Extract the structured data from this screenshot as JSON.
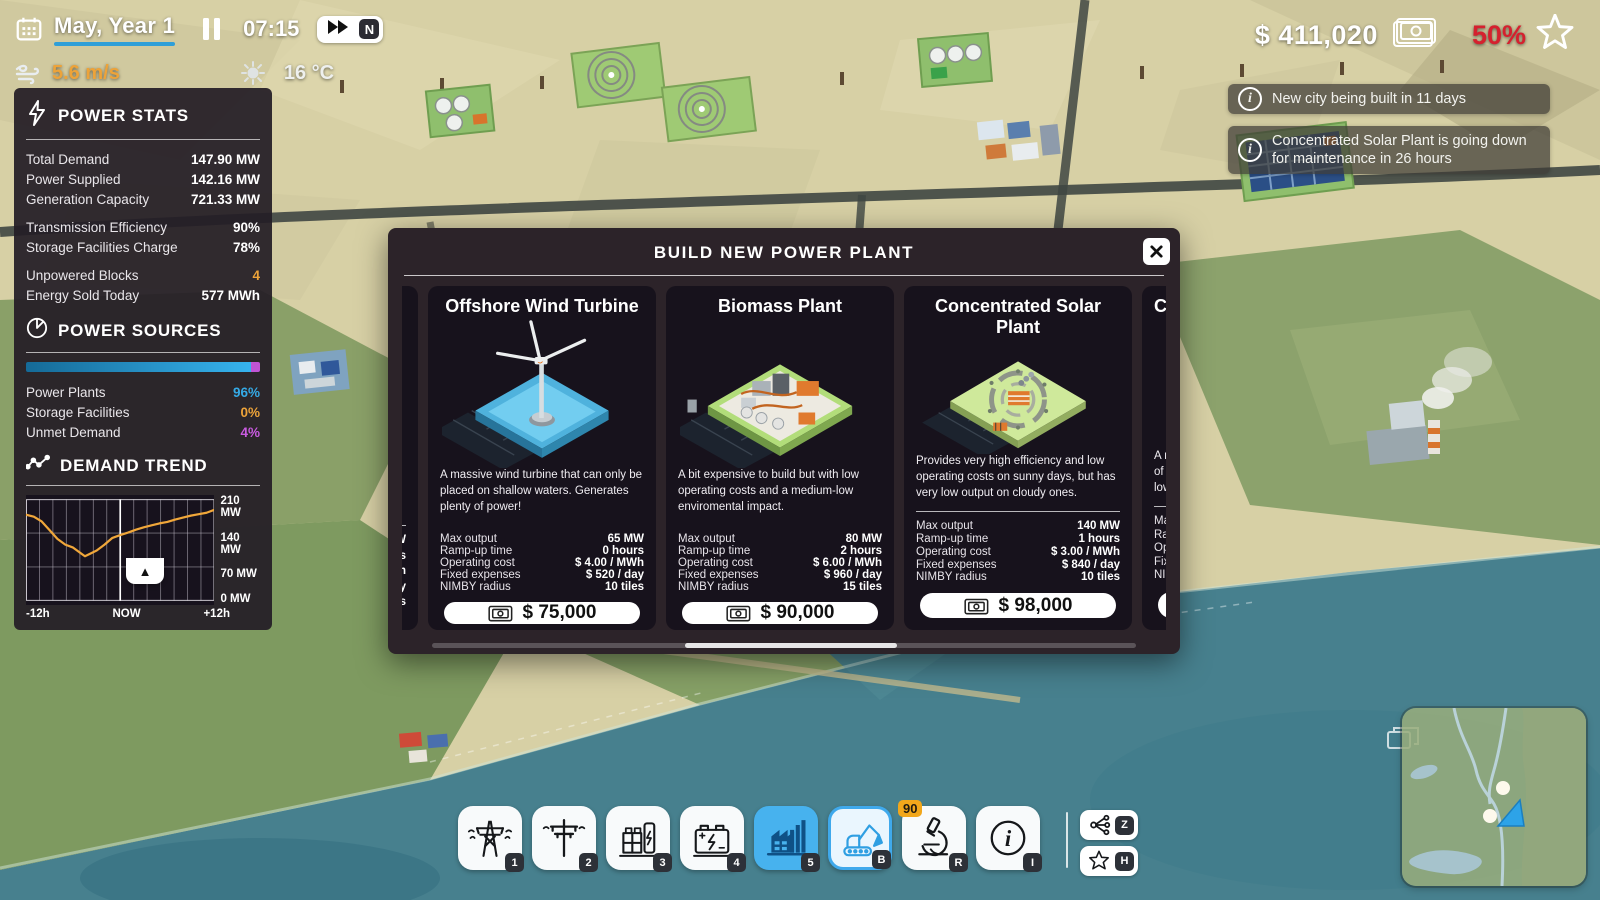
{
  "hud": {
    "date": "May, Year 1",
    "time": "07:15",
    "speed_mode": "N",
    "wind_speed": "5.6 m/s",
    "temperature": "16 °C",
    "money": "$ 411,020",
    "approval": "50%"
  },
  "notifications": [
    {
      "text": "New city being built in 11 days"
    },
    {
      "text": "Concentrated Solar Plant is going down for maintenance in 26 hours"
    }
  ],
  "power_stats": {
    "title": "POWER STATS",
    "rows": [
      {
        "label": "Total Demand",
        "value": "147.90 MW"
      },
      {
        "label": "Power Supplied",
        "value": "142.16 MW"
      },
      {
        "label": "Generation Capacity",
        "value": "721.33 MW"
      },
      {
        "label": "Transmission Efficiency",
        "value": "90%"
      },
      {
        "label": "Storage Facilities Charge",
        "value": "78%"
      },
      {
        "label": "Unpowered Blocks",
        "value": "4"
      },
      {
        "label": "Energy Sold Today",
        "value": "577 MWh"
      }
    ]
  },
  "power_sources": {
    "title": "POWER SOURCES",
    "bar": {
      "plants_pct": 96,
      "unmet_pct": 4
    },
    "rows": [
      {
        "label": "Power Plants",
        "value": "96%"
      },
      {
        "label": "Storage Facilities",
        "value": "0%"
      },
      {
        "label": "Unmet Demand",
        "value": "4%"
      }
    ]
  },
  "chart_data": {
    "type": "line",
    "title": "DEMAND TREND",
    "xlabel": "time relative to now (hours)",
    "ylabel": "MW",
    "ylim": [
      0,
      210
    ],
    "x_range": [
      -12,
      12
    ],
    "grid": true,
    "yticks": [
      "210 MW",
      "140 MW",
      "70 MW",
      "0 MW"
    ],
    "xticks": [
      "-12h",
      "NOW",
      "+12h"
    ],
    "series": [
      {
        "name": "Demand",
        "color": "#f0a73a",
        "points": [
          [
            -12,
            178
          ],
          [
            -11,
            174
          ],
          [
            -10,
            164
          ],
          [
            -9,
            146
          ],
          [
            -8,
            128
          ],
          [
            -7,
            116
          ],
          [
            -6,
            110
          ],
          [
            -5,
            98
          ],
          [
            -4.5,
            92
          ],
          [
            -4,
            96
          ],
          [
            -3,
            104
          ],
          [
            -2,
            116
          ],
          [
            -1,
            130
          ],
          [
            0,
            136
          ],
          [
            1,
            141
          ],
          [
            2,
            147
          ],
          [
            3,
            152
          ],
          [
            4,
            156
          ],
          [
            5,
            160
          ],
          [
            6,
            163
          ],
          [
            7,
            168
          ],
          [
            8,
            172
          ],
          [
            9,
            176
          ],
          [
            10,
            179
          ],
          [
            11,
            182
          ],
          [
            12,
            188
          ]
        ]
      }
    ]
  },
  "modal": {
    "title": "BUILD NEW POWER PLANT",
    "close_glyph": "✕",
    "cards": [
      {
        "title": "Offshore Wind Turbine",
        "description": "A massive wind turbine that can only be placed on shallow waters. Generates plenty of power!",
        "stats": [
          [
            "Max output",
            "65 MW"
          ],
          [
            "Ramp-up time",
            "0 hours"
          ],
          [
            "Operating cost",
            "$ 4.00 / MWh"
          ],
          [
            "Fixed expenses",
            "$ 520 / day"
          ],
          [
            "NIMBY radius",
            "10 tiles"
          ]
        ],
        "price": "$ 75,000"
      },
      {
        "title": "Biomass Plant",
        "description": "A bit expensive to build but with low operating costs and a medium-low enviromental impact.",
        "stats": [
          [
            "Max output",
            "80 MW"
          ],
          [
            "Ramp-up time",
            "2 hours"
          ],
          [
            "Operating cost",
            "$ 6.00 / MWh"
          ],
          [
            "Fixed expenses",
            "$ 960 / day"
          ],
          [
            "NIMBY radius",
            "15 tiles"
          ]
        ],
        "price": "$ 90,000"
      },
      {
        "title": "Concentrated Solar Plant",
        "description": "Provides very high efficiency and low operating costs on sunny days, but has very low output on cloudy ones.",
        "stats": [
          [
            "Max output",
            "140 MW"
          ],
          [
            "Ramp-up time",
            "1 hours"
          ],
          [
            "Operating cost",
            "$ 3.00 / MWh"
          ],
          [
            "Fixed expenses",
            "$ 840 / day"
          ],
          [
            "NIMBY radius",
            "10 tiles"
          ]
        ],
        "price": "$ 98,000"
      }
    ],
    "partial_left": {
      "fragments": [
        "W",
        "s",
        "h",
        "y",
        "s"
      ]
    },
    "partial_right": {
      "title_fragment": "Co",
      "desc_lines": [
        "A more",
        "of the",
        "low op"
      ],
      "stat_fragments": [
        "Max ou",
        "Ramp-",
        "Opera",
        "Fixed e",
        "NIMBY"
      ]
    }
  },
  "toolbar": {
    "buttons": [
      {
        "icon": "transmission-tower-icon",
        "hotkey": "1"
      },
      {
        "icon": "power-pole-icon",
        "hotkey": "2"
      },
      {
        "icon": "substation-icon",
        "hotkey": "3"
      },
      {
        "icon": "battery-icon",
        "hotkey": "4"
      },
      {
        "icon": "power-plant-icon",
        "hotkey": "5"
      },
      {
        "icon": "excavator-icon",
        "hotkey": "B"
      },
      {
        "icon": "microscope-icon",
        "hotkey": "R",
        "badge": "90"
      },
      {
        "icon": "info-icon",
        "hotkey": "I"
      }
    ],
    "side_buttons": [
      {
        "icon": "network-icon",
        "hotkey": "Z"
      },
      {
        "icon": "star-icon",
        "hotkey": "H"
      }
    ]
  },
  "icons": {
    "collapse": "▲",
    "info": "i"
  }
}
